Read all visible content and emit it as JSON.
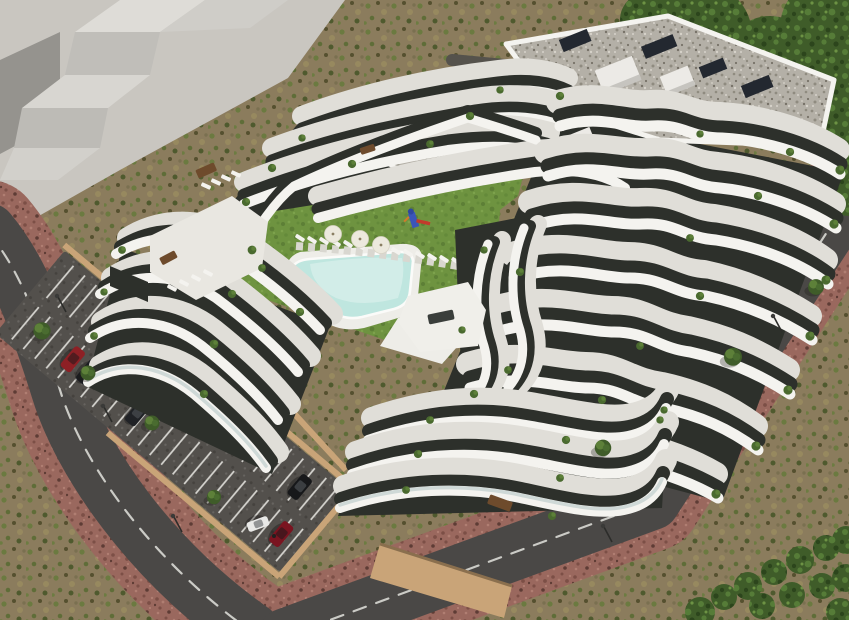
{
  "scene": {
    "type": "architectural-aerial-render",
    "description": "Aerial 3D rendering of a modern white terraced apartment complex with curved cascading balconies around a central courtyard featuring a lawn, free-form swimming pool, sun loungers, parasols and a playground; surface parking lot with cars, perimeter roads with dashed markings, red paver sidewalks, scrubland and trees; plain stepped concrete neighbor building at top-left",
    "palette": {
      "dirt": "#8b7c5d",
      "scrub_green": "#6b7a40",
      "plaza": "#c9c6c0",
      "neighbor_light": "#dedcd7",
      "neighbor_mid": "#c0beb9",
      "neighbor_dark": "#95938e",
      "road": "#4a4846",
      "road_minor": "#55524c",
      "road_line": "#d9d9d4",
      "sidewalk": "#9a685e",
      "parking_asphalt": "#53504c",
      "stall_line": "#d8d7d2",
      "wall_tan": "#c9a478",
      "lawn": "#6e9340",
      "lawn_dark": "#5d7f36",
      "pool": "#bfe6df",
      "pool_light": "#dff2ee",
      "deck": "#eeede8",
      "white": "#f4f3ef",
      "floor": "#e0ded8",
      "facade": "#2d302b",
      "gravel": "#b4b0a7",
      "solar_panel": "#232830",
      "canopy": "#3f5c29",
      "bush": "#4a6a2f",
      "bush_light": "#5d8039",
      "parasol": "#ece9dd",
      "furniture": "#6e4b2c",
      "glass": "#c8d4d2",
      "playground_blue": "#3b55b9",
      "slide_red": "#c23a2b",
      "bar_orange": "#d07a2a"
    },
    "neighbor_building": {
      "style": "stepped-concrete-blocks",
      "position": "top-left"
    },
    "complex": {
      "wings": [
        "north",
        "east",
        "south",
        "west"
      ],
      "floors_visible": 7,
      "roof": "gravel flat roof with white parapets, stair bulkheads and dark solar panels",
      "balcony_style": "curved organic white bands with recessed dark glazing and terrace planting"
    },
    "courtyard": {
      "lawn": true,
      "pool": true,
      "parasol_count": 3,
      "pool_lounger_count": 12,
      "terrace_lounger_count": 8,
      "playground": {
        "tower_color": "#3b55b9",
        "slide_color": "#c23a2b",
        "bar_color": "#d07a2a"
      }
    },
    "parking": {
      "car_count": 9,
      "cars": [
        {
          "label": "silver-car",
          "color": "#9aa0a3"
        },
        {
          "label": "charcoal-car",
          "color": "#2a2d31"
        },
        {
          "label": "teal-suv",
          "color": "#4e7a6e"
        },
        {
          "label": "gray-car",
          "color": "#3a3d42"
        },
        {
          "label": "black-car",
          "color": "#17181a"
        },
        {
          "label": "red-car",
          "color": "#8e2025"
        },
        {
          "label": "black-car-2",
          "color": "#1c1e22"
        },
        {
          "label": "black-car-3",
          "color": "#202226"
        },
        {
          "label": "dark-red-car",
          "color": "#7a1420"
        }
      ],
      "stall_line_color": "#d8d7d2",
      "wall_color": "#c9a478",
      "lamp_count": 5
    },
    "roads": {
      "surface_color": "#4a4846",
      "marking": "dashed-white-center-line",
      "marking_color": "#d9d9d4",
      "sidewalk_color": "#9a685e",
      "street_car": {
        "label": "white-car",
        "color": "#e9e9e7"
      }
    },
    "vegetation": {
      "street_tree_count": 6,
      "large_canopy": "top-right corner",
      "hedge": "bottom-right corner",
      "terrace_planting": "cypresses and shrubs along balcony edges"
    }
  }
}
